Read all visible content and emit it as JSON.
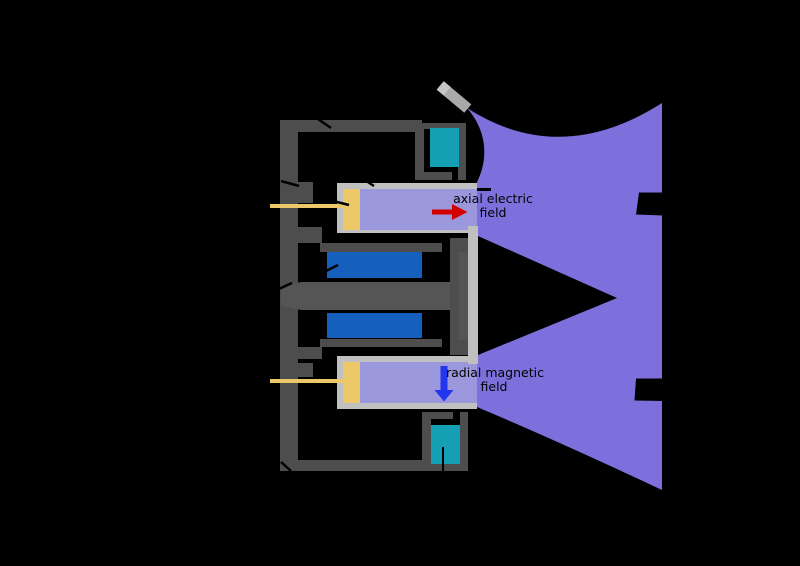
{
  "diagram": {
    "type": "hall-effect-thruster-cross-section",
    "background": "#000000",
    "labels": {
      "axial_field": {
        "line1": "axial electric",
        "line2": "field"
      },
      "radial_field": {
        "line1": "radial magnetic",
        "line2": "field"
      }
    },
    "arrows": [
      {
        "name": "axial-electric-field-arrow",
        "direction": "right",
        "color": "#d40000"
      },
      {
        "name": "radial-magnetic-field-arrow",
        "direction": "down",
        "color": "#2236ee"
      }
    ],
    "colors": {
      "structure_dark_gray": "#4d4d4d",
      "core_gray": "#555555",
      "casing_silver": "#c0c0c0",
      "cathode_gray": "#a9a9a9",
      "cathode_tip_gray": "#c6c6c6",
      "coil_blue": "#1560bd",
      "pole_coil_teal": "#149fb4",
      "anode_yellow": "#ecc869",
      "channel_purple": "#9b97dc",
      "plume_purple": "#7d70dc",
      "label_text": "#000000"
    },
    "parts": [
      "back-plate",
      "top-arm",
      "bottom-arm",
      "outer-pole-box-upper",
      "outer-pole-box-lower",
      "outer-coil-upper",
      "outer-coil-lower",
      "inner-coil-upper",
      "inner-coil-lower",
      "magnetic-core",
      "center-pole",
      "exit-plane-bracket",
      "discharge-channel-upper",
      "discharge-channel-lower",
      "anode-upper",
      "anode-lower",
      "propellant-feed-upper",
      "propellant-feed-lower",
      "cathode-neutralizer",
      "plasma-plume"
    ]
  }
}
